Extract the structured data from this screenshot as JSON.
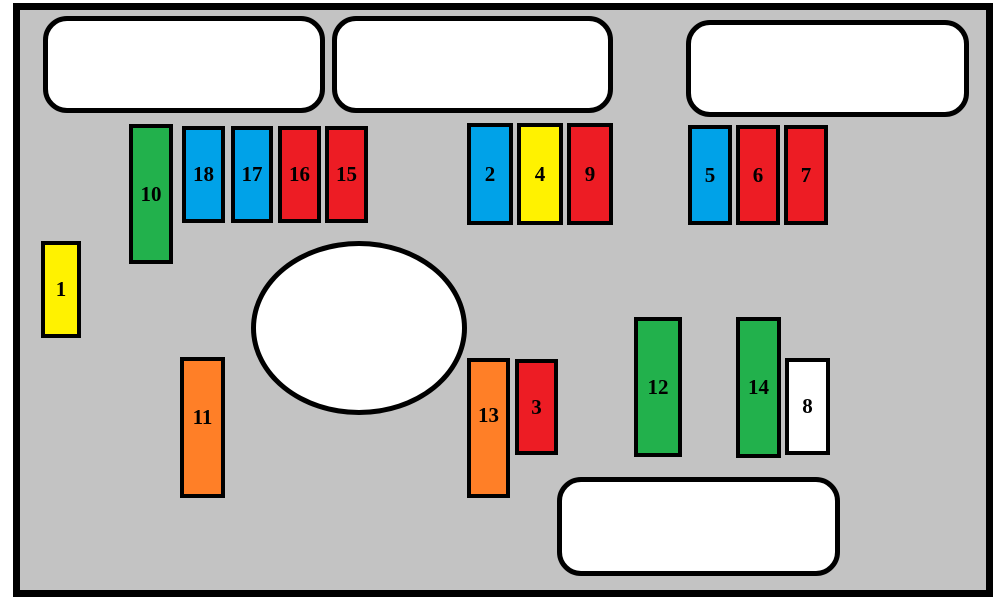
{
  "diagram": {
    "type": "fuse-box-layout",
    "canvas": {
      "w": 1001,
      "h": 599,
      "background": "#FFFFFF"
    },
    "panel": {
      "x": 13,
      "y": 3,
      "w": 980,
      "h": 594,
      "fill": "#C3C3C3",
      "border_color": "#000000",
      "border_width": 7
    },
    "colors": {
      "red": "#ED1C24",
      "blue": "#00A2E8",
      "green": "#22B14C",
      "yellow": "#FFF200",
      "orange": "#FF7F27",
      "white": "#FFFFFF",
      "panel_gray": "#C3C3C3",
      "outline_black": "#000000"
    },
    "connector_blocks": [
      {
        "name": "connector-block-top-left",
        "x": 43,
        "y": 16,
        "w": 282,
        "h": 97
      },
      {
        "name": "connector-block-top-middle",
        "x": 332,
        "y": 16,
        "w": 281,
        "h": 97
      },
      {
        "name": "connector-block-top-right",
        "x": 686,
        "y": 20,
        "w": 283,
        "h": 97
      },
      {
        "name": "connector-block-bottom",
        "x": 557,
        "y": 477,
        "w": 283,
        "h": 99
      }
    ],
    "ellipse": {
      "name": "center-ellipse",
      "x": 251,
      "y": 241,
      "w": 216,
      "h": 174
    },
    "fuses": [
      {
        "label": "1",
        "color": "yellow",
        "x": 41,
        "y": 241,
        "w": 40,
        "h": 97
      },
      {
        "label": "10",
        "color": "green",
        "x": 129,
        "y": 124,
        "w": 44,
        "h": 140
      },
      {
        "label": "18",
        "color": "blue",
        "x": 182,
        "y": 126,
        "w": 43,
        "h": 97
      },
      {
        "label": "17",
        "color": "blue",
        "x": 231,
        "y": 126,
        "w": 42,
        "h": 97
      },
      {
        "label": "16",
        "color": "red",
        "x": 278,
        "y": 126,
        "w": 43,
        "h": 97
      },
      {
        "label": "15",
        "color": "red",
        "x": 325,
        "y": 126,
        "w": 43,
        "h": 97
      },
      {
        "label": "2",
        "color": "blue",
        "x": 467,
        "y": 123,
        "w": 46,
        "h": 102
      },
      {
        "label": "4",
        "color": "yellow",
        "x": 517,
        "y": 123,
        "w": 46,
        "h": 102
      },
      {
        "label": "9",
        "color": "red",
        "x": 567,
        "y": 123,
        "w": 46,
        "h": 102
      },
      {
        "label": "5",
        "color": "blue",
        "x": 688,
        "y": 125,
        "w": 44,
        "h": 100
      },
      {
        "label": "6",
        "color": "red",
        "x": 736,
        "y": 125,
        "w": 44,
        "h": 100
      },
      {
        "label": "7",
        "color": "red",
        "x": 784,
        "y": 125,
        "w": 44,
        "h": 100
      },
      {
        "label": "11",
        "color": "orange",
        "x": 180,
        "y": 357,
        "w": 45,
        "h": 141,
        "label_dy": -10
      },
      {
        "label": "13",
        "color": "orange",
        "x": 467,
        "y": 358,
        "w": 43,
        "h": 140,
        "label_dy": -13
      },
      {
        "label": "3",
        "color": "red",
        "x": 515,
        "y": 359,
        "w": 43,
        "h": 96
      },
      {
        "label": "12",
        "color": "green",
        "x": 634,
        "y": 317,
        "w": 48,
        "h": 140
      },
      {
        "label": "14",
        "color": "green",
        "x": 736,
        "y": 317,
        "w": 45,
        "h": 141
      },
      {
        "label": "8",
        "color": "white",
        "x": 785,
        "y": 358,
        "w": 45,
        "h": 97
      }
    ]
  }
}
